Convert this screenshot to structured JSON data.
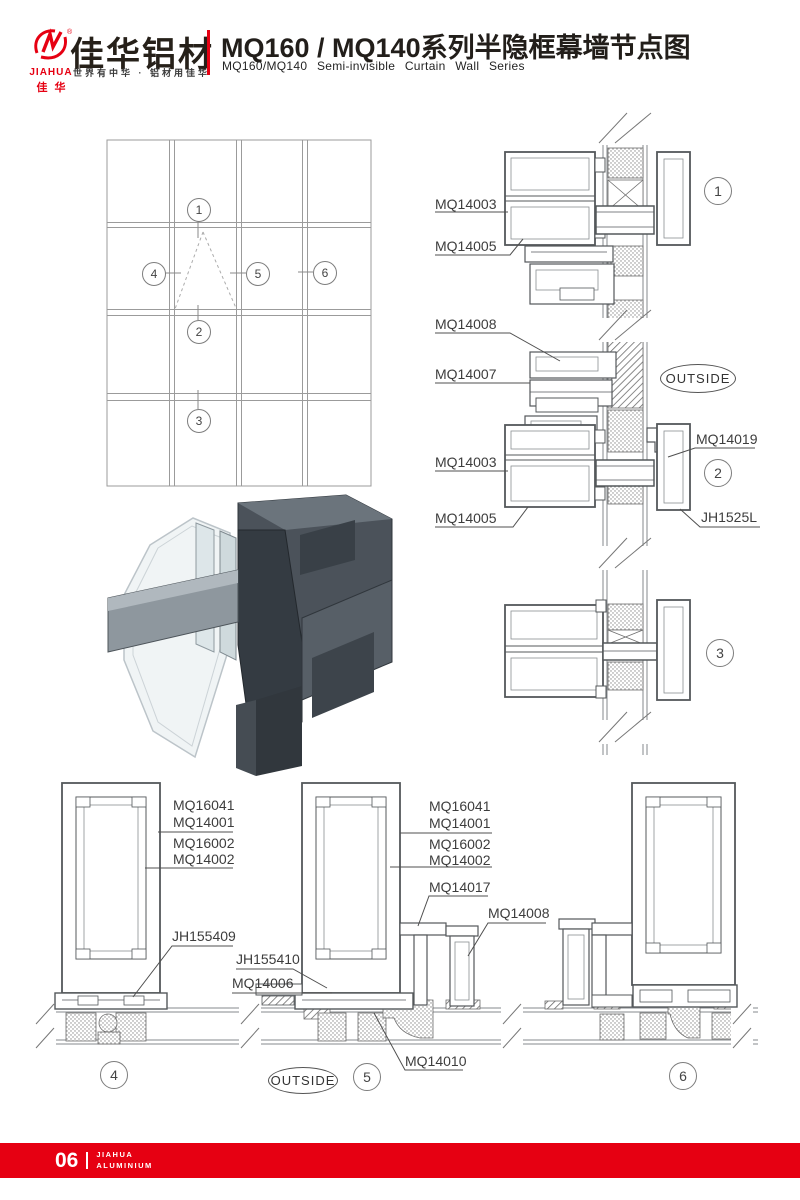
{
  "header": {
    "logo": {
      "brand_en": "JIAHUA",
      "brand_cn": "佳华",
      "reg": "®",
      "name_cn": "佳华铝材",
      "slogan": "世界有中华 · 铝材用佳华"
    },
    "title_cn": "MQ160 / MQ140系列半隐框幕墙节点图",
    "title_en": "MQ160/MQ140 Semi-invisible Curtain Wall Series",
    "accent_color": "#e60012"
  },
  "callouts": {
    "n1": "1",
    "n2": "2",
    "n3": "3",
    "n4": "4",
    "n5": "5",
    "n6": "6"
  },
  "labels": {
    "outside": "OUTSIDE",
    "mq14003": "MQ14003",
    "mq14005": "MQ14005",
    "mq14007": "MQ14007",
    "mq14008": "MQ14008",
    "mq14019": "MQ14019",
    "jh1525l": "JH1525L",
    "mq16041": "MQ16041",
    "mq14001": "MQ14001",
    "mq16002": "MQ16002",
    "mq14002": "MQ14002",
    "jh155409": "JH155409",
    "jh155410": "JH155410",
    "mq14006": "MQ14006",
    "mq14017": "MQ14017",
    "mq14010": "MQ14010"
  },
  "footer": {
    "page_number": "06",
    "brand_line1": "JIAHUA",
    "brand_line2": "ALUMINIUM"
  }
}
